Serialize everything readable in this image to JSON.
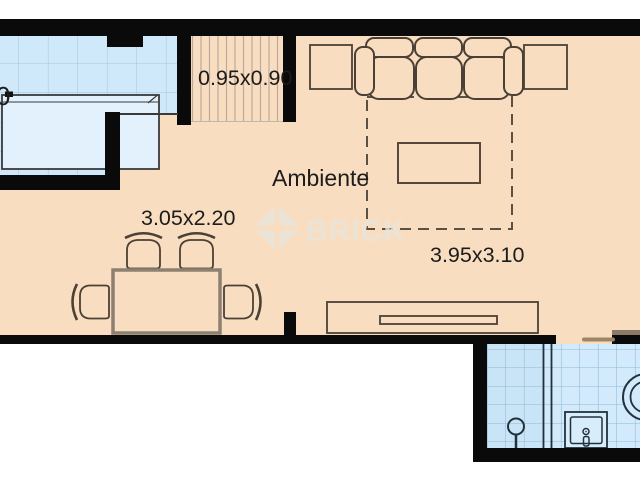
{
  "labels": {
    "room": "Ambiente",
    "closet_size": "0.95x0.90",
    "dining_size": "3.05x2.20",
    "living_size": "3.95x3.10",
    "edge_partial": "0"
  },
  "watermark": {
    "brand": "BRICK"
  },
  "colors": {
    "wall": "#0a0a0a",
    "floor": "#f9ddc1",
    "kitchen_tile": "#d0e9fa",
    "bath_tile_left": "#c9e4f6",
    "bath_tile_right": "#d2eafb",
    "grid_line": "#9fc5dc",
    "furniture_outline": "#4a4035",
    "table_outline": "#8c8070",
    "label_text": "#1c1c1c",
    "door": "#9b8668",
    "watermark": "#eae5dd"
  }
}
